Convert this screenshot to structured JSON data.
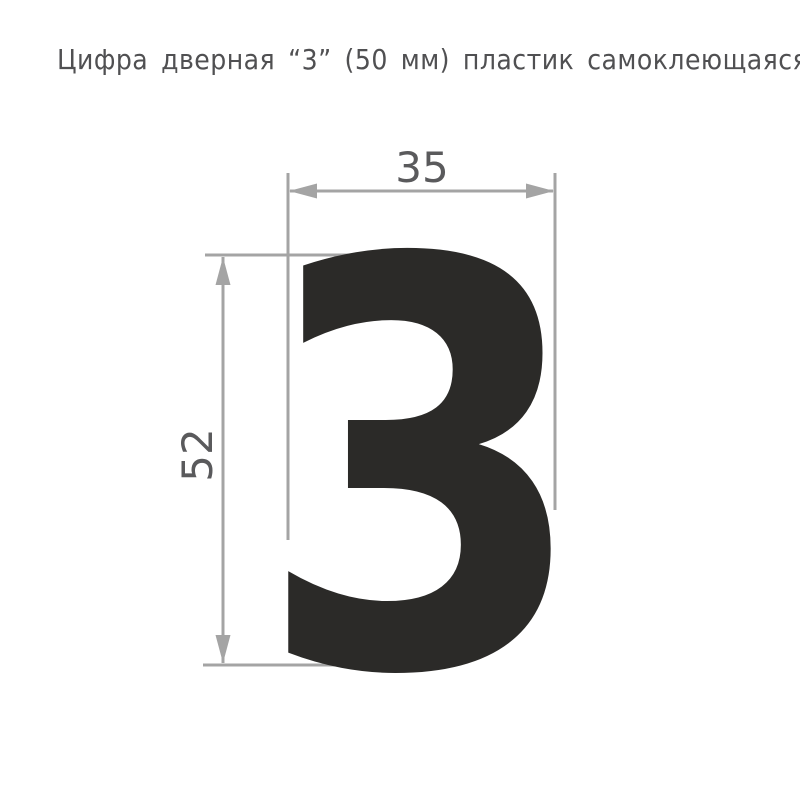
{
  "page": {
    "title": "Цифра дверная “3” (50 мм) пластик самоклеющаяся"
  },
  "drawing": {
    "digit": "3",
    "width_label": "35",
    "height_label": "52",
    "colors": {
      "digit": "#2b2a28",
      "lines": "#a4a4a4",
      "dim_text": "#5a5a5c",
      "title_text": "#505052"
    }
  }
}
